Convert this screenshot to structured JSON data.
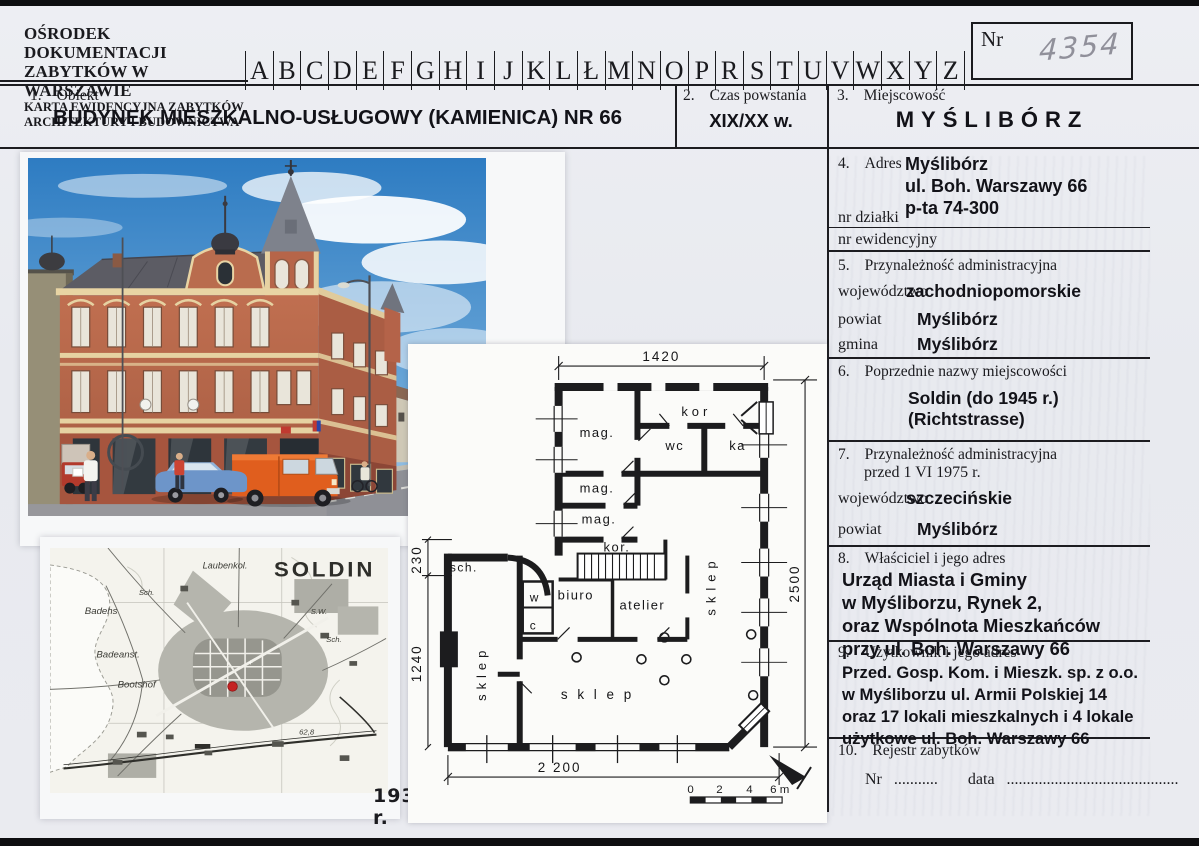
{
  "header": {
    "org_line1": "OŚRODEK DOKUMENTACJI",
    "org_line2": "ZABYTKÓW W WARSZAWIE",
    "org_line3": "KARTA EWIDENCYJNA ZABYTKÓW",
    "org_line4": "ARCHITEKTURY I BUDOWNICTWA",
    "alphabet": [
      "A",
      "B",
      "C",
      "D",
      "E",
      "F",
      "G",
      "H",
      "I",
      "J",
      "K",
      "L",
      "Ł",
      "M",
      "N",
      "O",
      "P",
      "R",
      "S",
      "T",
      "U",
      "V",
      "W",
      "X",
      "Y",
      "Z"
    ],
    "nr_label": "Nr",
    "nr_value": "4354"
  },
  "s1": {
    "no": "1.",
    "title": "Obiekt",
    "value": "BUDYNEK MIESZKALNO-USŁUGOWY (KAMIENICA) NR 66"
  },
  "s2": {
    "no": "2.",
    "title": "Czas powstania",
    "value": "XIX/XX w."
  },
  "s3": {
    "no": "3.",
    "title": "Miejscowość",
    "value": "MYŚLIBÓRZ"
  },
  "s4": {
    "no": "4.",
    "title": "Adres",
    "line1": "Myślibórz",
    "line2": "ul. Boh. Warszawy 66",
    "line3": "p-ta  74-300",
    "plot_label": "nr  działki",
    "record_label": "nr  ewidencyjny"
  },
  "s5": {
    "no": "5.",
    "title": "Przynależność administracyjna",
    "rows": [
      {
        "k": "województwo",
        "v": "zachodniopomorskie"
      },
      {
        "k": "powiat",
        "v": "Myślibórz"
      },
      {
        "k": "gmina",
        "v": "Myślibórz"
      }
    ]
  },
  "s6": {
    "no": "6.",
    "title": "Poprzednie nazwy miejscowości",
    "line1": "Soldin  (do 1945 r.)",
    "line2": "(Richtstrasse)"
  },
  "s7": {
    "no": "7.",
    "title": "Przynależność administracyjna",
    "title2": "przed 1 VI 1975 r.",
    "rows": [
      {
        "k": "województwo",
        "v": "szczecińskie"
      },
      {
        "k": "powiat",
        "v": "Myślibórz"
      }
    ]
  },
  "s8": {
    "no": "8.",
    "title": "Właściciel i jego adres",
    "lines": [
      "Urząd Miasta i Gminy",
      "w Myśliborzu, Rynek 2,",
      "oraz Wspólnota Mieszkańców",
      "przy ul. Boh. Warszawy 66"
    ]
  },
  "s9": {
    "no": "9.",
    "title": "Użytkownik i jego adres",
    "lines": [
      "Przed. Gosp. Kom. i Mieszk. sp. z o.o.",
      "w Myśliborzu ul. Armii Polskiej 14",
      "oraz 17 lokali mieszkalnych i 4 lokale",
      "użytkowe ul. Boh. Warszawy 66"
    ]
  },
  "s10": {
    "no": "10.",
    "title": "Rejestr zabytków",
    "nr_label": "Nr",
    "nr_dots": "...........",
    "data_label": "data",
    "data_dots": "..........................................."
  },
  "photo": {
    "caption": "1."
  },
  "map": {
    "title": "SOLDIN",
    "caption": "1934 r.",
    "labels": {
      "laubenkol": "Laubenkol.",
      "badehs": "Badehs",
      "badeanst": "Badeanst.",
      "bootshof": "Bootshof",
      "sch1": "Sch.",
      "sch2": "Sch.",
      "sw": "S.W.",
      "elev": "62,8"
    }
  },
  "plan": {
    "dims": {
      "top": "1420",
      "right": "2500",
      "bottom": "2 200",
      "left_upper": "230",
      "left_lower": "1240"
    },
    "rooms": {
      "mag1": "mag.",
      "mag2": "mag.",
      "mag3": "mag.",
      "kor_top": "kor",
      "kor_mid": "kor.",
      "wc": "wc",
      "ka": "ka",
      "sch": "sch.",
      "w": "w",
      "c": "c",
      "biuro": "biuro",
      "atelier": "atelier",
      "sklep_left": "sklep",
      "sklep_right": "sklep",
      "sklep_main": "s k l e p"
    },
    "scale": {
      "t0": "0",
      "t2": "2",
      "t4": "4",
      "t6": "6 m"
    }
  }
}
